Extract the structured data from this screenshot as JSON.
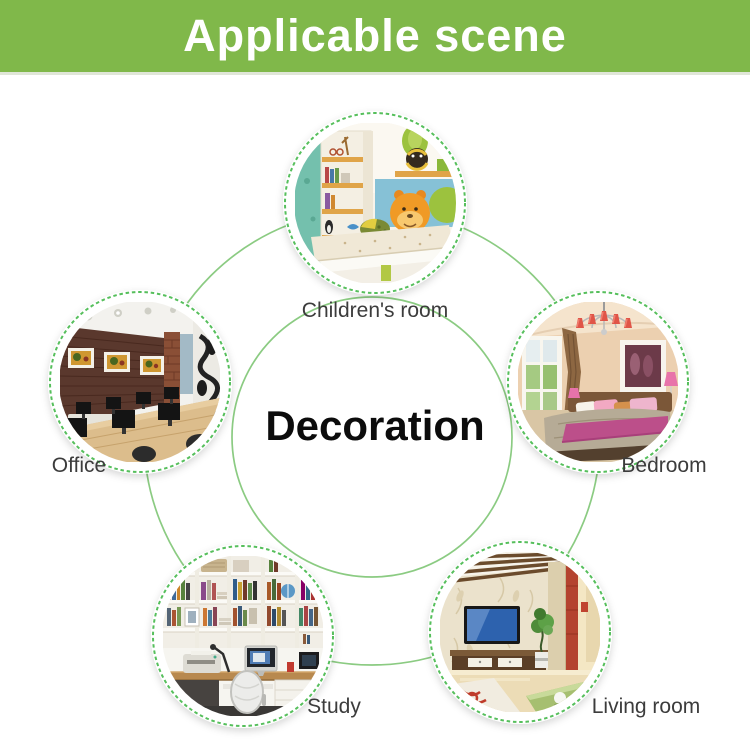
{
  "banner": {
    "title": "Applicable scene"
  },
  "center": {
    "label": "Decoration"
  },
  "scenes": [
    {
      "id": "children-room",
      "label": "Children's room"
    },
    {
      "id": "office",
      "label": "Office"
    },
    {
      "id": "bedroom",
      "label": "Bedroom"
    },
    {
      "id": "study",
      "label": "Study"
    },
    {
      "id": "living-room",
      "label": "Living room"
    }
  ],
  "colors": {
    "banner_green": "#80b84a",
    "ring_green": "#8bcb82",
    "dash_green": "#56bf5c",
    "label_text": "#3c3c3c",
    "title_text": "#ffffff",
    "center_text": "#0c0c0c"
  }
}
